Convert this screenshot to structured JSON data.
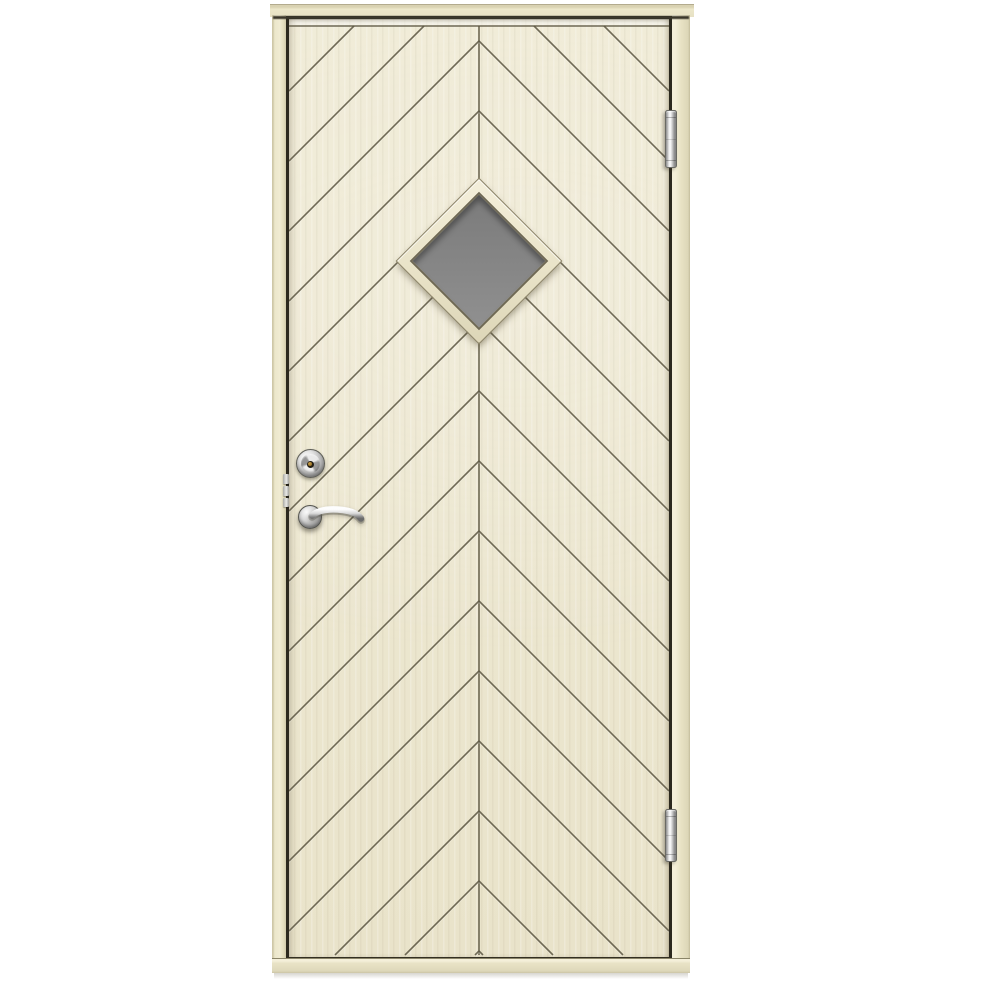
{
  "scene": {
    "subject": "cream-painted exterior door with chevron panel pattern, diamond window, lever handle and two barrel hinges",
    "background_color": "#ffffff"
  },
  "palette": {
    "frame_cream": "#e9e3c6",
    "frame_edge": "#b3ab8e",
    "door_cream": "#f0ebd7",
    "door_shade": "#e9e3ca",
    "groove_brown": "#5f5944",
    "gap_black": "#2c291e",
    "glass_gray": "#868686",
    "chrome_light": "#ffffff",
    "chrome_mid": "#c9c9c9",
    "chrome_dark": "#6f6f6f",
    "brass_pin": "#9c7427"
  },
  "door": {
    "chevron": {
      "direction": "up",
      "apex_spacing_px": 70,
      "first_apex_y_local": 22,
      "top_groove_y_local": 7,
      "center_x_local": 190,
      "field_width": 380,
      "field_height": 937,
      "stroke_width": 1.6,
      "angle_deg": 45
    },
    "window": {
      "shape": "diamond",
      "glass_color": "#868686",
      "frame_color": "#e9e3c8"
    },
    "hardware": {
      "lock_cylinder": {
        "finish": "chrome",
        "keyhole_pin_color": "#9c7427"
      },
      "lever_handle": {
        "finish": "chrome",
        "side": "left"
      },
      "edge_plate_segments": 3,
      "hinges": [
        {
          "position": "top-right",
          "finish": "chrome"
        },
        {
          "position": "bottom-right",
          "finish": "chrome"
        }
      ]
    }
  }
}
